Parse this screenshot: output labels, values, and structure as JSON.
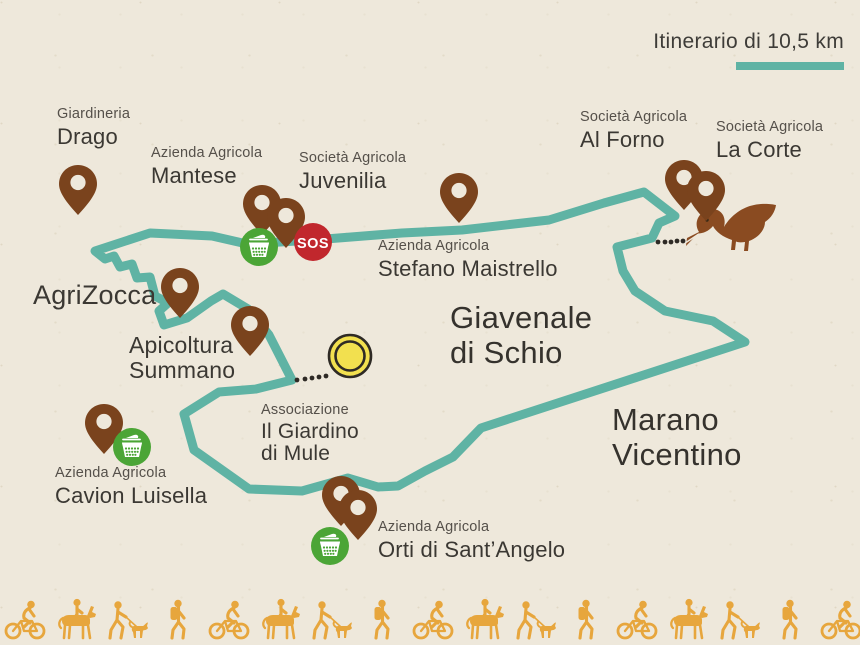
{
  "header": {
    "title": "Itinerario di 10,5 km"
  },
  "regions": {
    "giavenale": {
      "line1": "Giavenale",
      "line2": "di Schio"
    },
    "marano": {
      "line1": "Marano",
      "line2": "Vicentino"
    }
  },
  "locations": {
    "drago": {
      "small": "Giardineria",
      "large": "Drago"
    },
    "mantese": {
      "small": "Azienda Agricola",
      "large": "Mantese"
    },
    "juvenilia": {
      "small": "Società Agricola",
      "large": "Juvenilia"
    },
    "maistrello": {
      "small": "Azienda Agricola",
      "large": "Stefano Maistrello"
    },
    "alforno": {
      "small": "Società Agricola",
      "large": "Al Forno"
    },
    "lacorte": {
      "small": "Società Agricola",
      "large": "La Corte"
    },
    "agrizocca": {
      "large": "AgriZocca"
    },
    "apicoltura": {
      "large1": "Apicoltura",
      "large2": "Summano"
    },
    "mule": {
      "small": "Associazione",
      "large1": "Il Giardino",
      "large2": "di Mule"
    },
    "cavion": {
      "small": "Azienda Agricola",
      "large": "Cavion Luisella"
    },
    "orti": {
      "small": "Azienda Agricola",
      "large": "Orti di Sant’Angelo"
    }
  },
  "badges": {
    "sos": "SOS"
  },
  "colors": {
    "paper": "#EEE8DB",
    "route_teal": "#5FB3A4",
    "pin_brown": "#7A431D",
    "duck_brown": "#8A4B21",
    "basket_green": "#4BA536",
    "sos_red": "#C1272D",
    "start_yellow": "#F2E04F",
    "figures_orange": "#E7A63D",
    "text_dark": "#3B3833"
  }
}
